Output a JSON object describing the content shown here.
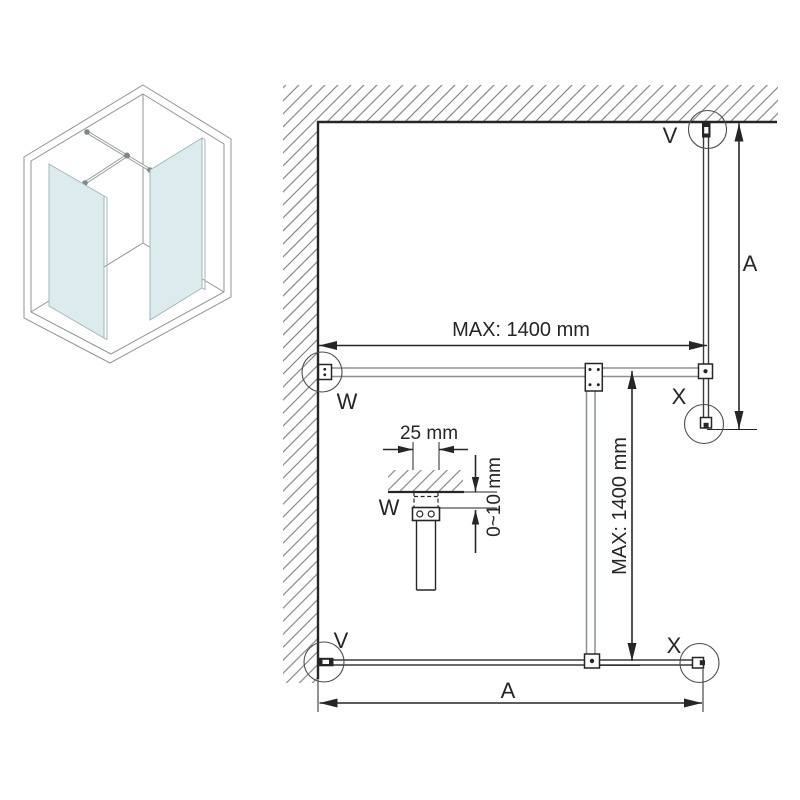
{
  "diagram_title": "walk-in-shower-installation-plan",
  "colors": {
    "ink": "#262626",
    "hatch": "#707070",
    "glass": "#dcecee",
    "iso_line": "#8f9599",
    "bar": "#8a9093",
    "background": "#ffffff"
  },
  "plan": {
    "dim_max_width": "MAX: 1400 mm",
    "dim_max_depth": "MAX: 1400 mm",
    "dim_a_right": "A",
    "dim_a_bottom": "A",
    "label_v_top": "V",
    "label_v_bottom": "V",
    "label_w": "W",
    "label_x_right": "X",
    "label_x_bottom": "X"
  },
  "detail": {
    "dim_bracket_width": "25 mm",
    "dim_gap": "0~10 mm",
    "label_w": "W"
  }
}
